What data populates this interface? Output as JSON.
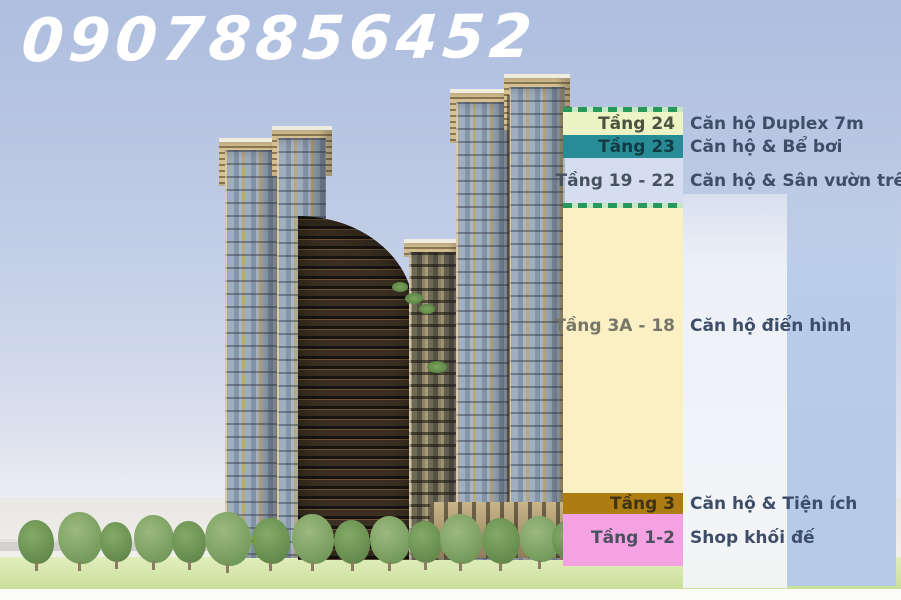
{
  "phone_number": "09078856452",
  "legend": {
    "rows": [
      {
        "floor": "Tầng 24",
        "description": "Căn hộ Duplex 7m",
        "band_color": "#ecf4c6"
      },
      {
        "floor": "Tầng 23",
        "description": "Căn hộ & Bể bơi",
        "band_color": "#288c97"
      },
      {
        "floor": "Tầng 19 - 22",
        "description": "Căn hộ & Sân vườn trên cao",
        "band_color": "rgba(237,242,248,0.5)"
      },
      {
        "floor": "Tầng 3A - 18",
        "description": "Căn hộ điển hình",
        "band_color": "#fbf0c3"
      },
      {
        "floor": "Tầng 3",
        "description": "Căn hộ & Tiện ích",
        "band_color": "#ae7d12"
      },
      {
        "floor": "Tầng 1-2",
        "description": "Shop khối đế",
        "band_color": "#f5a2e2"
      }
    ],
    "separator_color": "#27995a"
  },
  "colors": {
    "sky_top": "#aebedf",
    "sky_bottom": "#f4f3f2",
    "phone_text": "#ffffff",
    "description_text": "#3e4d68",
    "grass": "#c8de99",
    "tower_frame": "#b9a77e",
    "tower_glass": "#9fafbf"
  }
}
